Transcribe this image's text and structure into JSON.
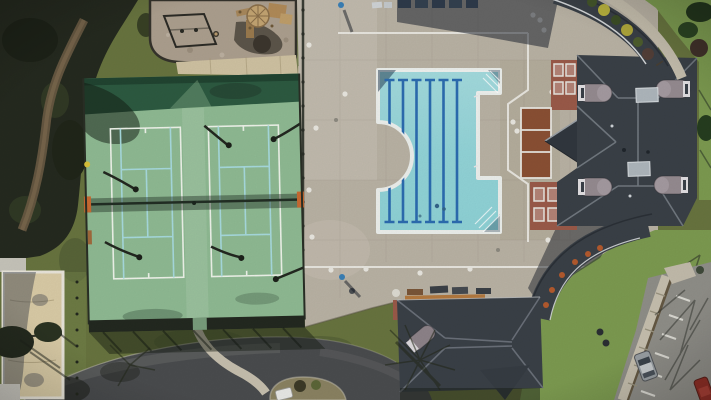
{
  "scene": {
    "type": "aerial-photo",
    "description": "Aerial drone view of a community recreation center: two tennis courts, a six-lane swimming pool on a concrete deck, a sand volleyball court, a playground, a clubhouse with curved covered walkways, a bath house, an access road with landscaped island, and a parking lot with two parked cars.",
    "objects": [
      {
        "id": "tennis-courts",
        "label": "Two tennis courts",
        "count": 2
      },
      {
        "id": "swimming-pool",
        "label": "Lap pool with six lane lines",
        "lanes": 6
      },
      {
        "id": "sand-volleyball-court",
        "label": "Sand volleyball court"
      },
      {
        "id": "playground",
        "label": "Playground with wooden play structure and swing set"
      },
      {
        "id": "pool-deck",
        "label": "Concrete pool deck with painted boundary lines"
      },
      {
        "id": "clubhouse",
        "label": "Clubhouse with hip roof and four barrel dormers",
        "dormers": 4
      },
      {
        "id": "covered-walkways",
        "label": "Curved covered walkways",
        "count": 2
      },
      {
        "id": "bath-house",
        "label": "Bath house pavilion"
      },
      {
        "id": "access-road",
        "label": "Curved access road with landscaped island"
      },
      {
        "id": "parking-lot",
        "label": "Parking lot",
        "cars": [
          "silver",
          "red",
          "white"
        ]
      },
      {
        "id": "people",
        "label": "People on pool deck",
        "count": 2
      }
    ]
  },
  "palette": {
    "grass_base": "#68743f",
    "grass_bright": "#7c9a50",
    "gravel": "#ac9f8e",
    "court_surface": "#8fba93",
    "court_band": "#2d5a41",
    "sand": "#d9cba6",
    "deck": "#b9b2a4",
    "water": "#8ed2d6",
    "lane_blue": "#2c6cb0",
    "roof_dark": "#3a4047",
    "dormer_gray": "#958b90",
    "brick": "#9a5a49",
    "porch_wood": "#8a5034",
    "road": "#4a4c4e",
    "parking": "#8f8e88",
    "path_concrete": "#c6bfae",
    "island_mulch": "#8a8262",
    "post_orange": "#c96a32",
    "chair_orange": "#b35a2e",
    "car_silver": "#9aa0a4",
    "car_red": "#8e2f26",
    "person_blue": "#3a7fb5"
  }
}
